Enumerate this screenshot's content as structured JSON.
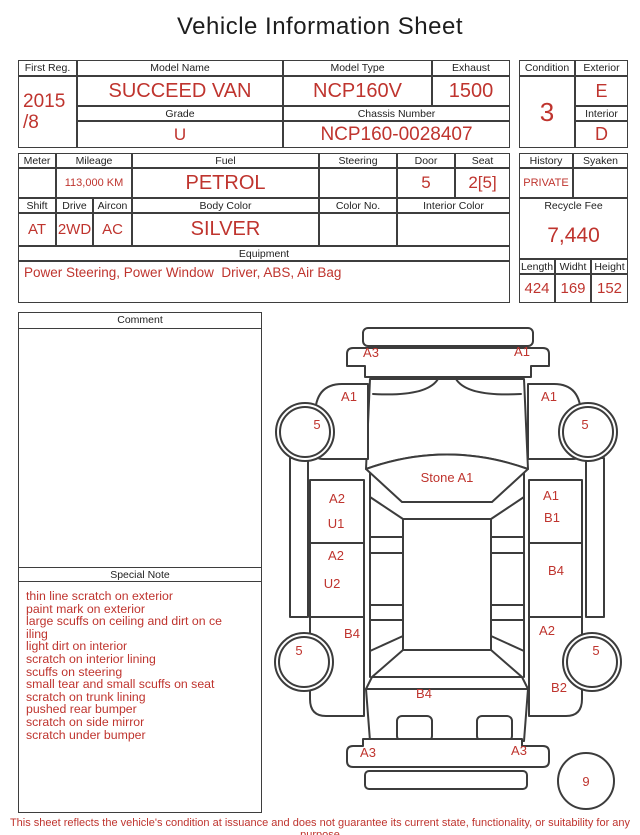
{
  "title": "Vehicle Information Sheet",
  "colors": {
    "accent": "#bf342e",
    "line": "#3c3c3c"
  },
  "top_table": {
    "first_reg": {
      "label": "First Reg.",
      "line1": "2015",
      "line2": "/8"
    },
    "model_name": {
      "label": "Model Name",
      "value": "SUCCEED VAN"
    },
    "model_type": {
      "label": "Model Type",
      "value": "NCP160V"
    },
    "exhaust": {
      "label": "Exhaust",
      "value": "1500"
    },
    "grade": {
      "label": "Grade",
      "value": "U"
    },
    "chassis_number": {
      "label": "Chassis Number",
      "value": "NCP160-0028407"
    },
    "condition": {
      "label": "Condition",
      "value": "3"
    },
    "exterior": {
      "label": "Exterior",
      "value": "E"
    },
    "interior": {
      "label": "Interior",
      "value": "D"
    }
  },
  "spec_table": {
    "meter": {
      "label": "Meter",
      "value": ""
    },
    "mileage": {
      "label": "Mileage",
      "value": "113,000 KM"
    },
    "fuel": {
      "label": "Fuel",
      "value": "PETROL"
    },
    "steering": {
      "label": "Steering",
      "value": ""
    },
    "door": {
      "label": "Door",
      "value": "5"
    },
    "seat": {
      "label": "Seat",
      "value": "2[5]"
    },
    "history": {
      "label": "History",
      "value": "PRIVATE"
    },
    "syaken": {
      "label": "Syaken",
      "value": ""
    },
    "shift": {
      "label": "Shift",
      "value": "AT"
    },
    "drive": {
      "label": "Drive",
      "value": "2WD"
    },
    "aircon": {
      "label": "Aircon",
      "value": "AC"
    },
    "body_color": {
      "label": "Body Color",
      "value": "SILVER"
    },
    "color_no": {
      "label": "Color No.",
      "value": ""
    },
    "interior_color": {
      "label": "Interior Color",
      "value": ""
    },
    "recycle_fee": {
      "label": "Recycle Fee",
      "value": "7,440"
    },
    "equipment": {
      "label": "Equipment",
      "value": "Power Steering, Power Window  Driver, ABS, Air Bag"
    },
    "length": {
      "label": "Length",
      "value": "424"
    },
    "width": {
      "label": "Widht",
      "value": "169"
    },
    "height": {
      "label": "Height",
      "value": "152"
    }
  },
  "comment": {
    "label": "Comment",
    "value": ""
  },
  "special_note": {
    "label": "Special Note",
    "lines": [
      "thin line scratch on exterior",
      "paint mark on exterior",
      "large scuffs on ceiling and dirt on ce",
      "iling",
      "light dirt on interior",
      "scratch on interior lining",
      "scuffs on steering",
      "small tear and small scuffs on seat",
      "scratch on trunk lining",
      "pushed rear bumper",
      "scratch on side mirror",
      "scratch under bumper"
    ]
  },
  "diagram": {
    "labels": [
      {
        "id": "front-bumper-left",
        "text": "A3"
      },
      {
        "id": "front-bumper-right",
        "text": "A1"
      },
      {
        "id": "front-left-fender",
        "text": "A1"
      },
      {
        "id": "front-right-fender",
        "text": "A1"
      },
      {
        "id": "front-left-wheel",
        "text": "5"
      },
      {
        "id": "front-right-wheel",
        "text": "5"
      },
      {
        "id": "windshield",
        "text": "Stone A1"
      },
      {
        "id": "left-front-door-line1",
        "text": "A2"
      },
      {
        "id": "left-front-door-line2",
        "text": "U1"
      },
      {
        "id": "right-front-door-line1",
        "text": "A1"
      },
      {
        "id": "right-front-door-line2",
        "text": "B1"
      },
      {
        "id": "left-rear-door-line1",
        "text": "A2"
      },
      {
        "id": "left-rear-door-line2",
        "text": "U2"
      },
      {
        "id": "right-rear-door",
        "text": "B4"
      },
      {
        "id": "left-quarter-panel",
        "text": "B4"
      },
      {
        "id": "right-quarter-panel",
        "text": "A2"
      },
      {
        "id": "rear-left-wheel",
        "text": "5"
      },
      {
        "id": "rear-right-wheel",
        "text": "5"
      },
      {
        "id": "right-rear-corner",
        "text": "B2"
      },
      {
        "id": "rear-hatch",
        "text": "B4"
      },
      {
        "id": "rear-bumper-left",
        "text": "A3"
      },
      {
        "id": "rear-bumper-right",
        "text": "A3"
      },
      {
        "id": "overall-score",
        "text": "9"
      }
    ]
  },
  "footer": "This sheet reflects the vehicle's condition at issuance and does not guarantee its current state, functionality, or suitability for any purpose"
}
